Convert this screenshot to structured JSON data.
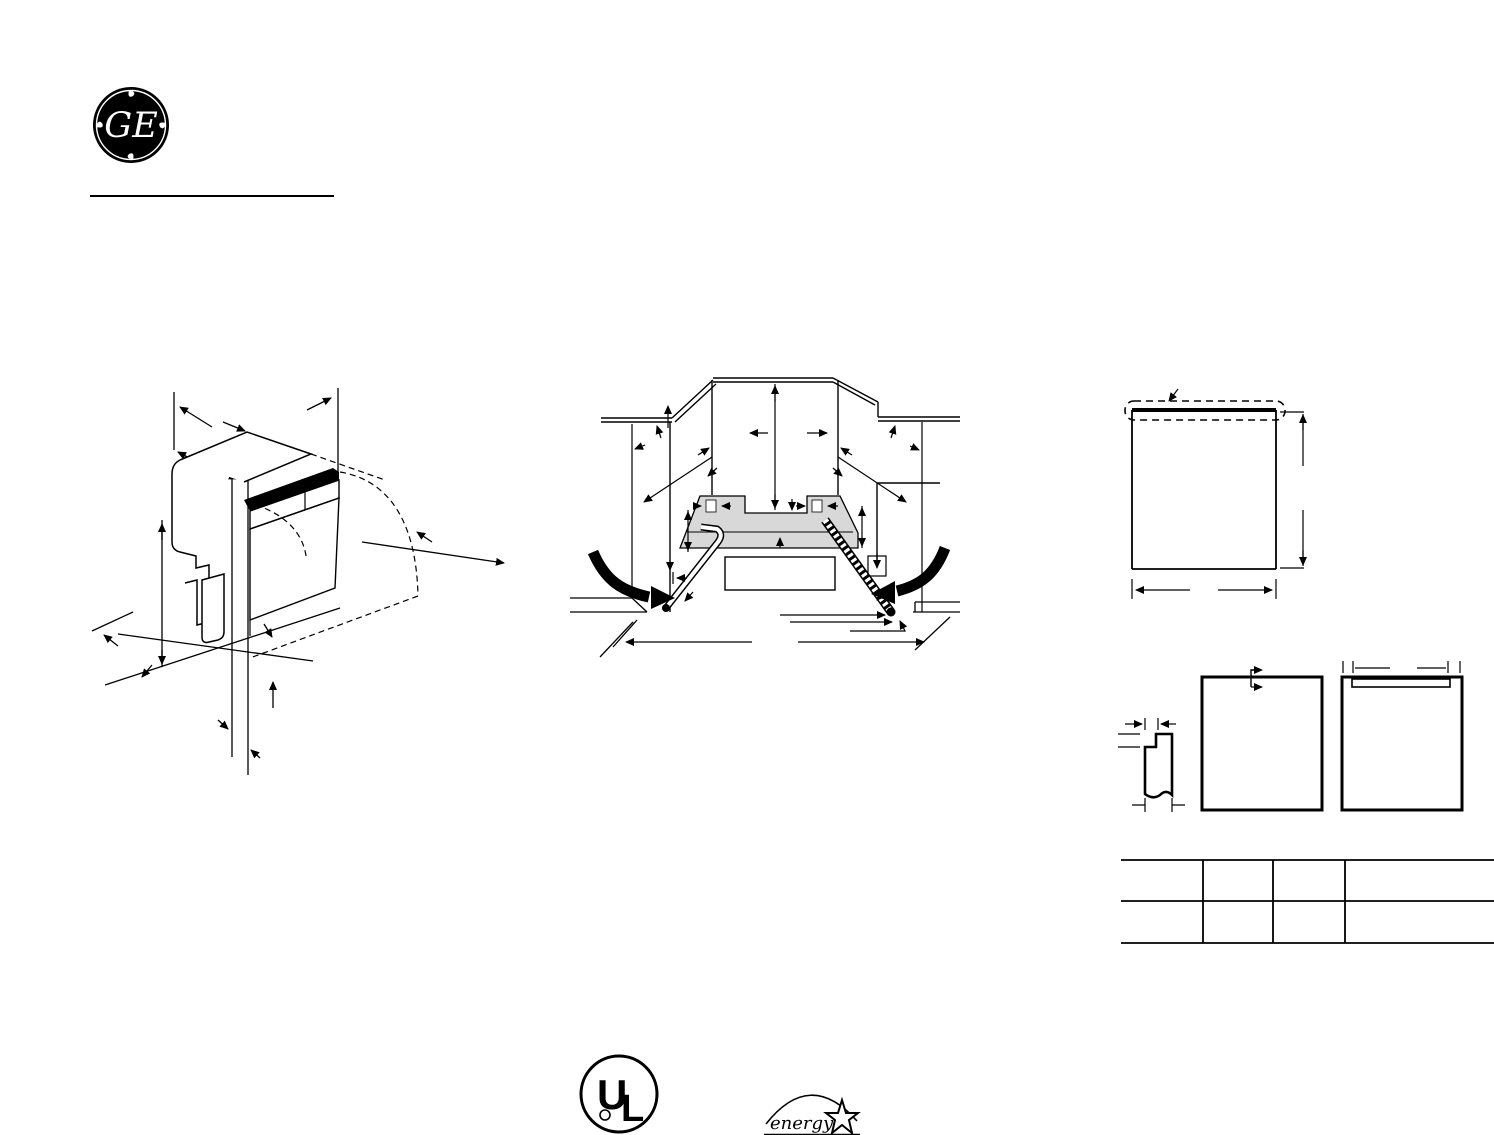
{
  "header": {
    "brand_monogram": "GE"
  },
  "figures": {
    "figure_isometric": "dishwasher-isometric-dimension-diagram",
    "figure_opening": "cabinet-opening-installation-diagram",
    "figure_door_panel": "door-panel-trim-diagram",
    "figure_panel_options": "custom-panel-dimension-diagrams"
  },
  "table": {
    "rows": 2,
    "columns": 4,
    "cells": [
      [
        "",
        "",
        "",
        ""
      ],
      [
        "",
        "",
        "",
        ""
      ]
    ]
  },
  "certifications": {
    "ul": {
      "letter_u": "U",
      "letter_l": "L"
    },
    "energy_star": {
      "word": "energy"
    }
  },
  "colors": {
    "ink": "#000000",
    "shading": "#d8d8d8",
    "paper": "#ffffff"
  }
}
